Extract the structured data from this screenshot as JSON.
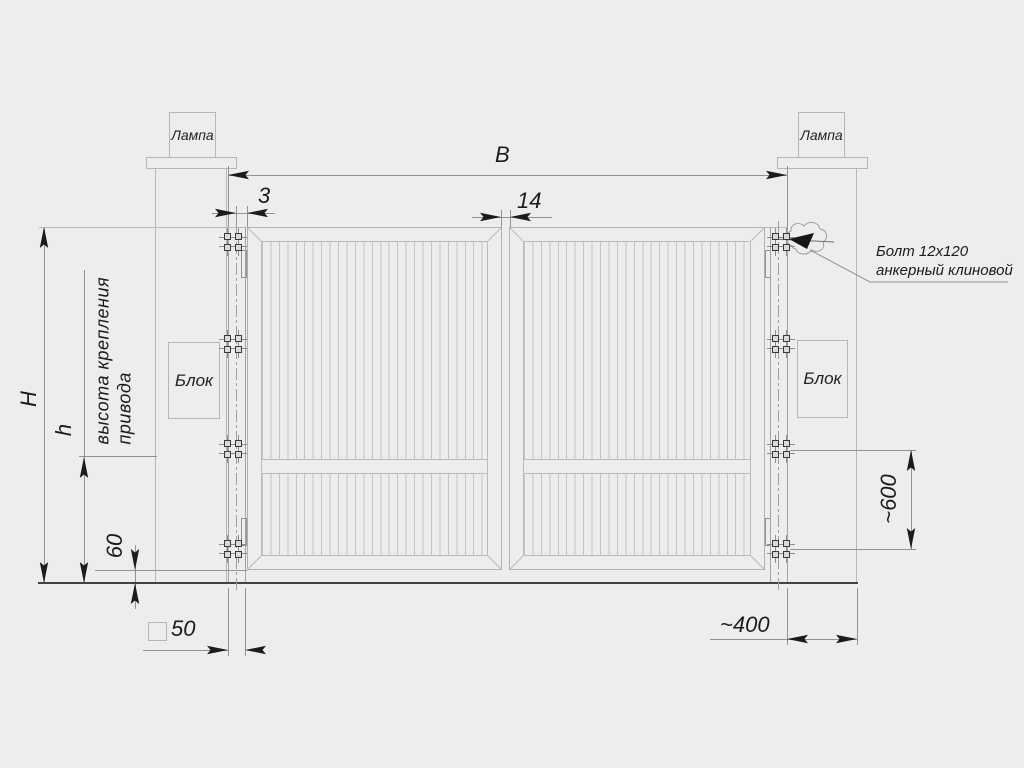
{
  "labels": {
    "lamp_left": "Лампа",
    "lamp_right": "Лампа",
    "block_left": "Блок",
    "block_right": "Блок"
  },
  "dimensions": {
    "opening_width": "B",
    "post_gap": "3",
    "center_gap": "14",
    "total_height": "H",
    "drive_height": "h",
    "drive_note_line1": "высота крепления",
    "drive_note_line2": "привода",
    "ground_clearance": "60",
    "profile_size": "50",
    "post_width": "~400",
    "bracket_spacing": "~600"
  },
  "callout": {
    "bolt_line1": "Болт 12x120",
    "bolt_line2": "анкерный клиновой"
  }
}
